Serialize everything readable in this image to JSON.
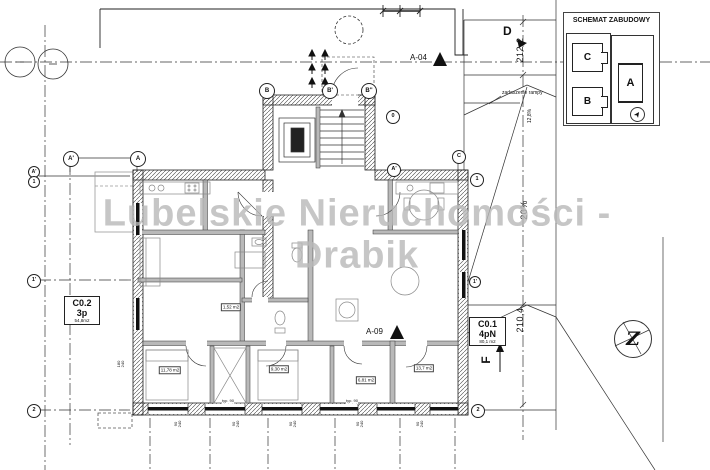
{
  "watermark": {
    "line1": "Lubelskie Nieruchomości -",
    "line2": "Drabik"
  },
  "inset": {
    "title": "SCHEMAT ZABUDOWY",
    "building_a": "A",
    "building_b": "B",
    "building_c": "C"
  },
  "units": {
    "c02": {
      "id": "C0.2",
      "layout": "3p",
      "area": "54,8m2"
    },
    "c01": {
      "id": "C0.1",
      "layout": "4pN",
      "area": "80,1 m2"
    }
  },
  "markers": {
    "a04": "A-04",
    "a09": "A-09",
    "d": "D",
    "f": "F"
  },
  "dims": {
    "v1": "212,2",
    "v2": "210,4",
    "s1": "12,8%",
    "s2": "20%"
  },
  "notes": {
    "ramp": "zadaszenie rampy",
    "typ90": "typ. 90"
  },
  "compass": {
    "north": "Z"
  },
  "axis_bubbles": [
    {
      "label": "A'"
    },
    {
      "label": "A"
    },
    {
      "label": "B"
    },
    {
      "label": "B'"
    },
    {
      "label": "B''"
    },
    {
      "label": "0"
    },
    {
      "label": "A'"
    },
    {
      "label": "C"
    },
    {
      "label": "1"
    },
    {
      "label": "1'"
    },
    {
      "label": "2"
    },
    {
      "label": "A'"
    },
    {
      "label": "1"
    },
    {
      "label": "1'"
    },
    {
      "label": "2"
    }
  ],
  "room_areas": [
    {
      "label": "11,78 m2"
    },
    {
      "label": "9,30 m2"
    },
    {
      "label": "6,81 m2"
    },
    {
      "label": "13,7 m2"
    },
    {
      "label": "1,52 m2"
    }
  ],
  "window_dims": [
    {
      "w": "180",
      "s": "240"
    },
    {
      "w": "90",
      "s": "240"
    },
    {
      "w": "90",
      "s": "240"
    },
    {
      "w": "90",
      "s": "240"
    },
    {
      "w": "90",
      "s": "240"
    },
    {
      "w": "90",
      "s": "240"
    }
  ]
}
